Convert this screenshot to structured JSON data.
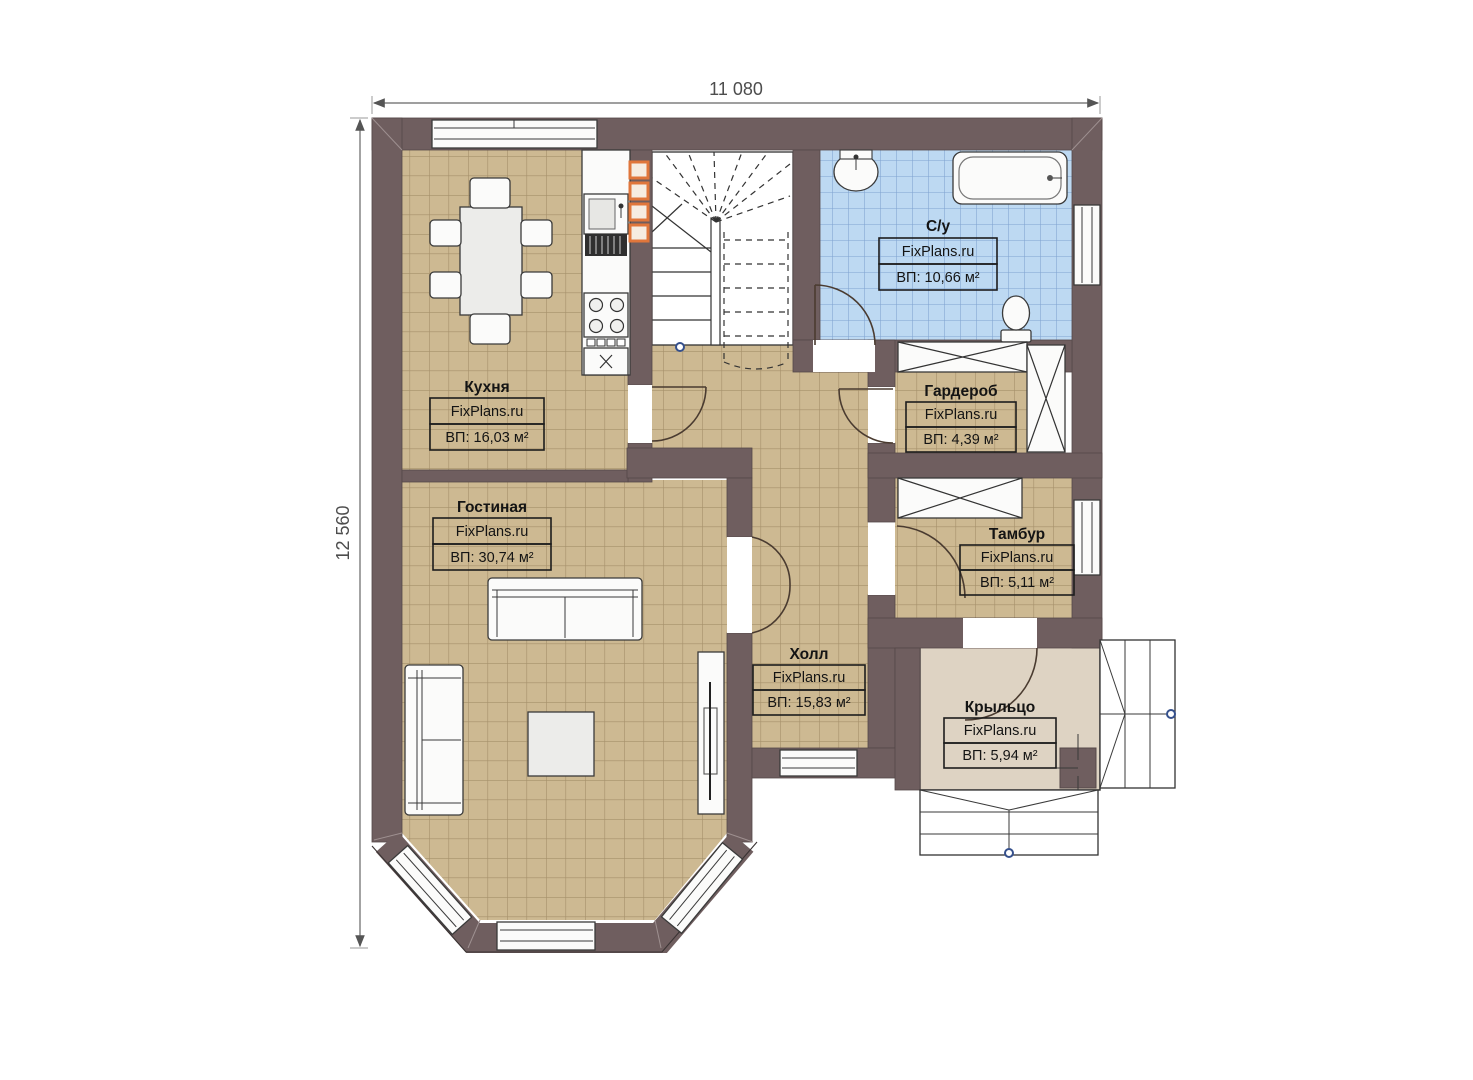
{
  "plan": {
    "type": "floor-plan",
    "brand_watermark": "FixPlans.ru",
    "dims": {
      "width": "11 080",
      "height": "12 560"
    },
    "rooms": [
      {
        "id": "kitchen",
        "name": "Кухня",
        "brand": "FixPlans.ru",
        "area": "ВП: 16,03 м²"
      },
      {
        "id": "living",
        "name": "Гостиная",
        "brand": "FixPlans.ru",
        "area": "ВП: 30,74 м²"
      },
      {
        "id": "bathroom",
        "name": "С/у",
        "brand": "FixPlans.ru",
        "area": "ВП: 10,66 м²"
      },
      {
        "id": "wardrobe",
        "name": "Гардероб",
        "brand": "FixPlans.ru",
        "area": "ВП: 4,39 м²"
      },
      {
        "id": "vestibule",
        "name": "Тамбур",
        "brand": "FixPlans.ru",
        "area": "ВП: 5,11 м²"
      },
      {
        "id": "hall",
        "name": "Холл",
        "brand": "FixPlans.ru",
        "area": "ВП: 15,83 м²"
      },
      {
        "id": "porch",
        "name": "Крыльцо",
        "brand": "FixPlans.ru",
        "area": "ВП: 5,94 м²"
      }
    ],
    "colors": {
      "wall": "#6f5e5f",
      "floor_tan": "#cdb992",
      "tile_line_tan": "#a5906a",
      "floor_blue": "#bdd9f2",
      "tile_line_blue": "#7fa3d0",
      "porch_floor": "#ded3c3",
      "cabinet_orange": "#e0763b",
      "marker_blue": "#35508c"
    }
  }
}
